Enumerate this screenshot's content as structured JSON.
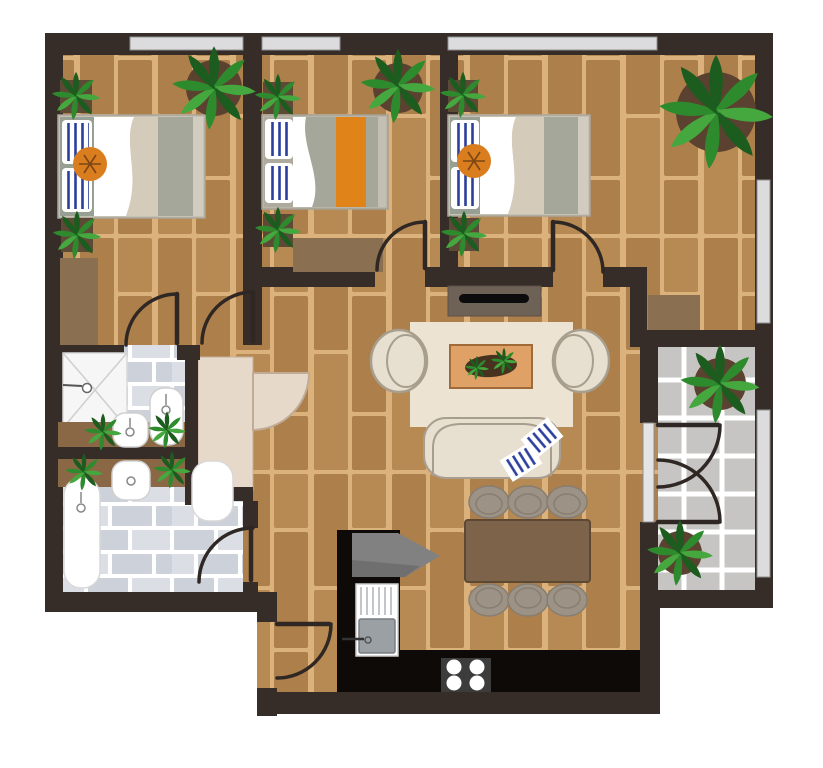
{
  "title": "apartment-floor-plan",
  "palette": {
    "wall": "#362c28",
    "woodGap": "#dcb27c",
    "plank": "#ad7f4a",
    "plankAlt": "#b68a52",
    "bathTile": "#cdd2da",
    "bathTileAlt": "#dbdfe5",
    "balconyTile": "#c6c5c3",
    "grout": "#ffffff",
    "window": "#dcdcde",
    "windowStroke": "#8f8f8f",
    "glassDoor": "#e4e4e6",
    "rug": "#ece3d2",
    "sofa": "#e7dfcf",
    "sofaLine": "#a89e8e",
    "coffeeTable": "#dfa165",
    "coffeeTableBorder": "#a06b38",
    "planter": "#46321f",
    "diningTable": "#7c6349",
    "diningTableBorder": "#5c4833",
    "chair": "#9c9286",
    "chairLine": "#877d71",
    "counter": "#0d0a08",
    "stove": "#3c3c3c",
    "burner": "#ffffff",
    "appliance": "#818181",
    "applianceDark": "#6f6f6f",
    "closet": "#e7d9ca",
    "closetLine": "#c3b09c",
    "vanity": "#8a6845",
    "fixture": "#ffffff",
    "fixtureLine": "#cfcfcf",
    "shower": "#f6f6f6",
    "potSquare": "#5d4a36",
    "potRound": "#5b4130",
    "leafDark": "#1c5c1e",
    "leafMid": "#2e8b2d",
    "leafLight": "#44a83e",
    "bedFrame": "#c6c1b3",
    "bedHead": "#98a094",
    "sheet": "#ffffff",
    "blanketBeige": "#d5cbba",
    "blanketGray": "#a5a79b",
    "bedFoot": "#d2ccc0",
    "stripe": "#2c3f9c",
    "cushion": "#d97d1f",
    "cushionLine": "#7a4613",
    "dresser": "#8a6f51",
    "console": "#6e6156",
    "tv": "#0c0c0c",
    "arc": "#2f2724",
    "basin": "#9aa0a4"
  },
  "inventory": {
    "rooms": [
      {
        "name": "bedroom-top-left",
        "floor": "wood",
        "furniture": [
          "double-bed",
          "striped-pillows",
          "round-cushion",
          "dresser",
          "potted-plants"
        ]
      },
      {
        "name": "bedroom-top-middle",
        "floor": "wood",
        "furniture": [
          "double-bed-orange-runner",
          "striped-pillows",
          "dresser",
          "potted-plants"
        ]
      },
      {
        "name": "bedroom-top-right",
        "floor": "wood",
        "furniture": [
          "double-bed",
          "striped-pillows",
          "round-cushion",
          "corner-plant",
          "alcove-rug"
        ]
      },
      {
        "name": "bathroom-upper",
        "floor": "tile",
        "furniture": [
          "corner-shower",
          "toilet",
          "bidet",
          "vanity-with-plants"
        ]
      },
      {
        "name": "bathroom-lower",
        "floor": "tile",
        "furniture": [
          "bathtub",
          "bidet",
          "toilet",
          "vanity-with-plants"
        ]
      },
      {
        "name": "closet",
        "floor": "plain",
        "furniture": [
          "fan-door"
        ]
      },
      {
        "name": "living-dining-room",
        "floor": "wood",
        "furniture": [
          "tv-console",
          "rug",
          "two-armchairs",
          "sofa-with-striped-cushions",
          "coffee-table-planter",
          "dining-table",
          "six-chairs"
        ]
      },
      {
        "name": "kitchen",
        "floor": "wood",
        "furniture": [
          "l-counter",
          "sink",
          "stove-4-burners",
          "appliance"
        ]
      },
      {
        "name": "entry-corridor",
        "floor": "wood",
        "furniture": [
          "entry-door"
        ]
      },
      {
        "name": "balcony",
        "floor": "tile",
        "furniture": [
          "french-doors",
          "potted-plants"
        ]
      }
    ],
    "window_count": 5,
    "door_count": 9,
    "plant_count": 15
  }
}
